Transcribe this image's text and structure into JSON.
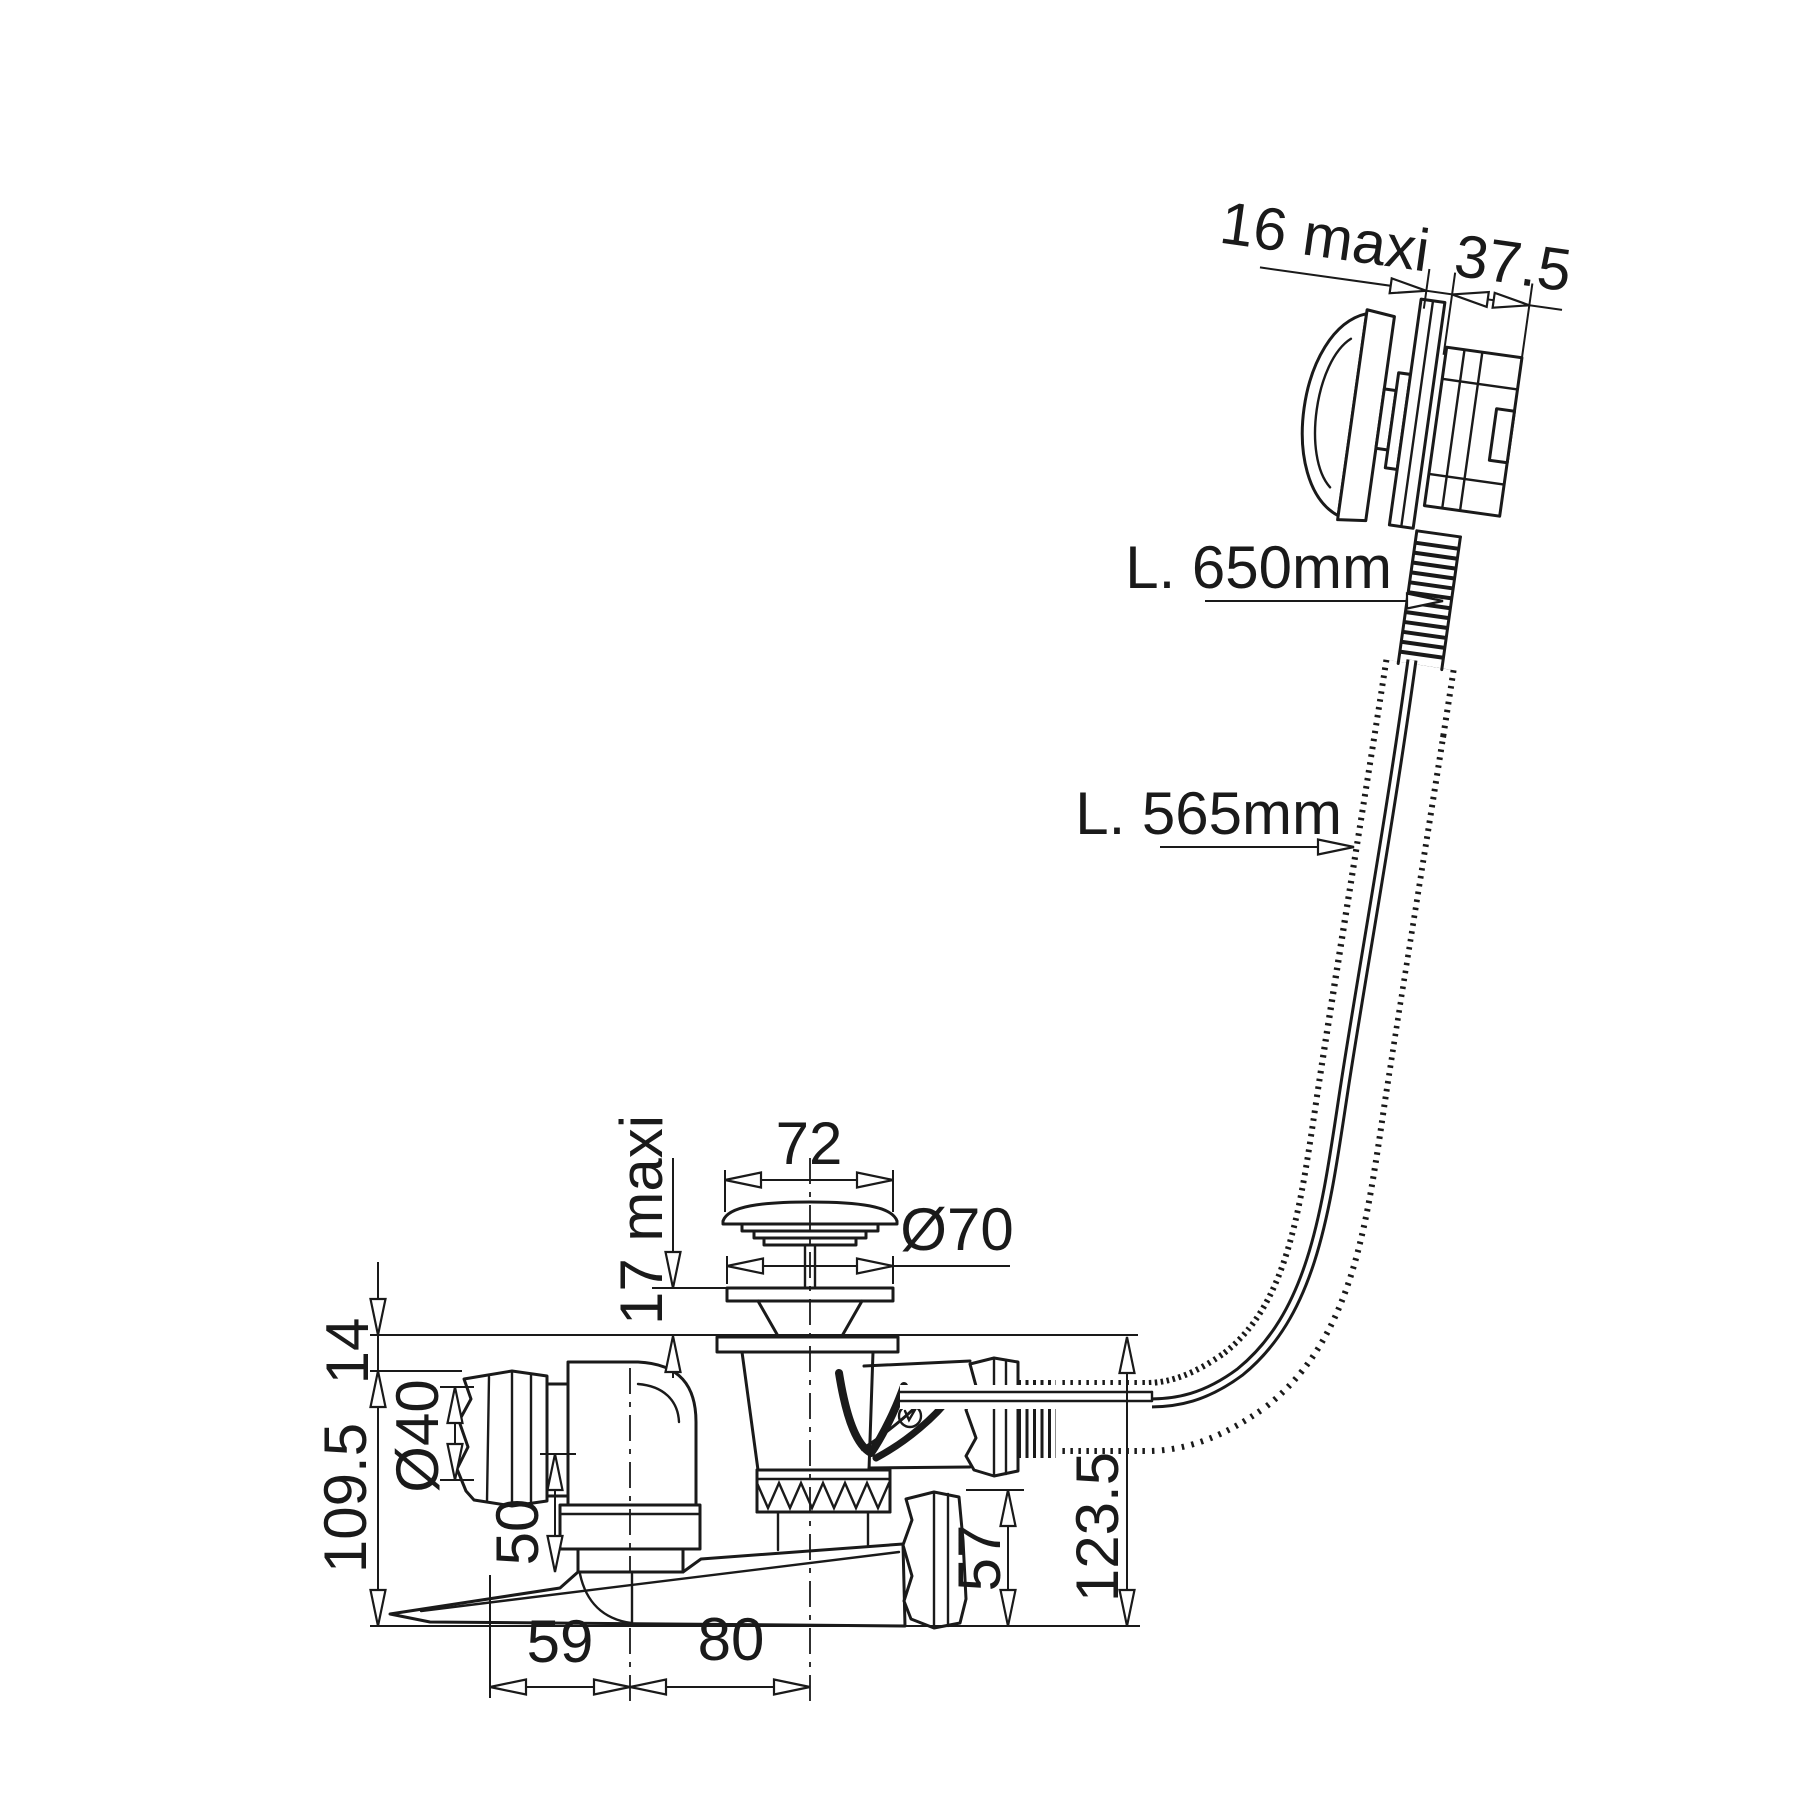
{
  "drawing": {
    "title": "Bath waste and overflow kit - dimensioned technical drawing",
    "colors": {
      "background": "#ffffff",
      "line": "#1a1a1a"
    },
    "dimensions": {
      "overflow": {
        "wall_max": "16 maxi",
        "body_depth": "37.5"
      },
      "cable": {
        "total_length": "L. 650mm",
        "sheath_length": "L. 565mm"
      },
      "plug": {
        "cap_width": "72",
        "flange_diameter": "Ø70",
        "lift_max": "17 maxi"
      },
      "body": {
        "flange_offset": "14",
        "inlet_diameter": "Ø40",
        "height_left": "109.5",
        "elbow_drop": "50",
        "outlet_left": "59",
        "outlet_right": "80",
        "nut_height": "57",
        "height_right": "123.5"
      }
    }
  }
}
